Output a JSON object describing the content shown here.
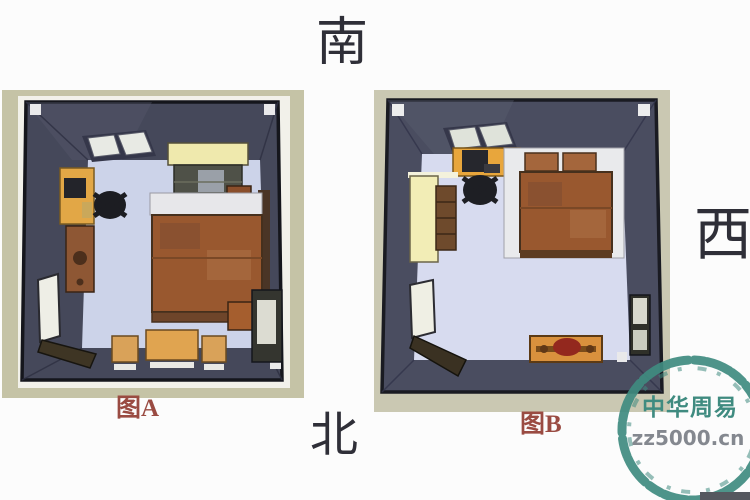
{
  "directions": {
    "south": "南",
    "north": "北",
    "west": "西"
  },
  "figures": [
    {
      "label": "图A",
      "furniture": [
        "skylight-window",
        "wardrobe",
        "desk-with-computer",
        "office-chair",
        "dresser",
        "double-bed",
        "nightstand-top",
        "nightstand-bottom",
        "tea-table",
        "stool-left",
        "stool-right",
        "open-entry-door",
        "side-door"
      ]
    },
    {
      "label": "图B",
      "furniture": [
        "skylight-window",
        "desk-with-computer",
        "office-chair",
        "double-bed",
        "wardrobe",
        "open-entry-door",
        "side-door",
        "bench"
      ]
    }
  ],
  "watermark": {
    "line1": "中华周易",
    "line2": "zz5000.cn"
  },
  "colors": {
    "caption_red": "#9a4b42",
    "direction_text": "#2f2f38",
    "wall_dark": "#45485a",
    "floor_lavender": "#ccd3e9",
    "frame_beige": "#c5c3a6",
    "bed_rust": "#99582f",
    "wardrobe_yellow": "#f2edb6",
    "desk_orange": "#e8a63c",
    "watermark_teal": "#3f8b80",
    "watermark_gray": "#84888f"
  }
}
